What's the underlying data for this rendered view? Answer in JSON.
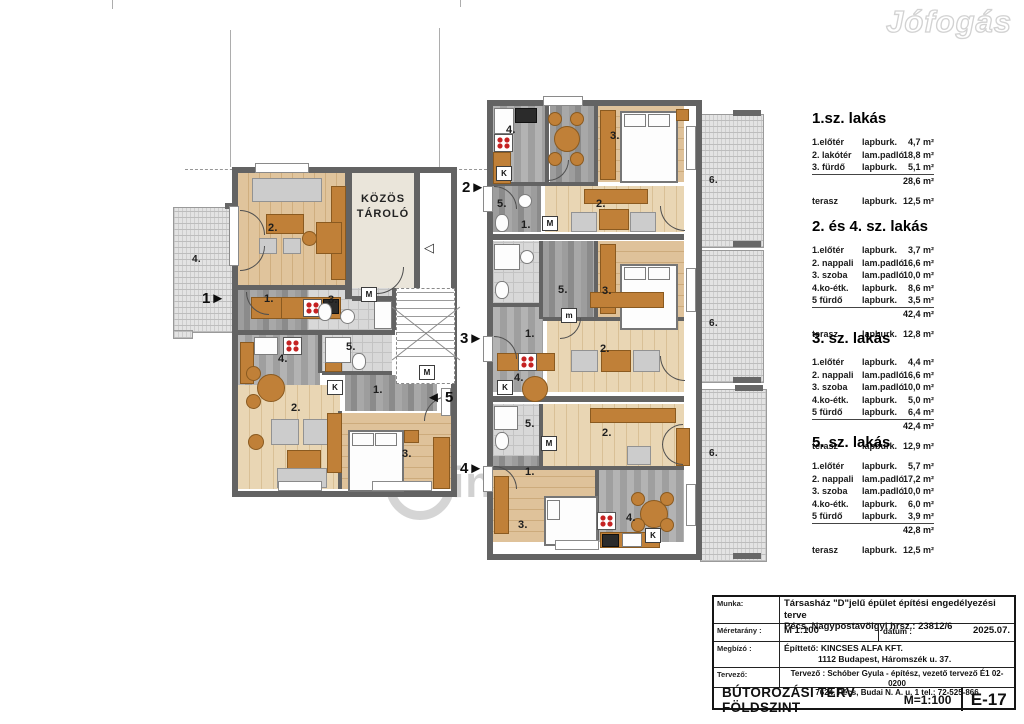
{
  "watermarks": {
    "top_right": "Jófogás",
    "center": "ingatlanpont"
  },
  "plan": {
    "kozos_line1": "KÖZÖS",
    "kozos_line2": "TÁROLÓ",
    "door_mark": "◁",
    "entrances": [
      "1►",
      "2►",
      "3►",
      "4►",
      "◄ 5"
    ],
    "terraces": [
      "4.",
      "6.",
      "6.",
      "6."
    ],
    "left_rooms": [
      "2.",
      "1.",
      "3.",
      "4.",
      "5.",
      "1.",
      "2.",
      "3."
    ],
    "u1_rooms": [
      "4.",
      "3.",
      "5.",
      "2.",
      "1."
    ],
    "u2_rooms": [
      "5.",
      "3.",
      "1.",
      "2.",
      "4."
    ],
    "u3_rooms": [
      "5.",
      "2.",
      "1.",
      "3.",
      "4."
    ],
    "appliances": [
      "M",
      "K",
      "M",
      "K",
      "M",
      "m",
      "K",
      "M",
      "K"
    ]
  },
  "legend": [
    {
      "title": "1.sz. lakás",
      "rows": [
        {
          "n": "1.előtér",
          "f": "lapburk.",
          "a": "4,7 m²"
        },
        {
          "n": "2. lakótér",
          "f": "lam.padló",
          "a": "18,8 m²"
        },
        {
          "n": "3. fürdő",
          "f": "lapburk.",
          "a": "5,1 m²"
        }
      ],
      "total": "28,6 m²",
      "tn": "terasz",
      "tf": "lapburk.",
      "ta": "12,5 m²"
    },
    {
      "title": "2. és 4. sz. lakás",
      "rows": [
        {
          "n": "1.előtér",
          "f": "lapburk.",
          "a": "3,7 m²"
        },
        {
          "n": "2. nappali",
          "f": "lam.padló",
          "a": "16,6 m²"
        },
        {
          "n": "3. szoba",
          "f": "lam.padló",
          "a": "10,0 m²"
        },
        {
          "n": "4.ko-étk.",
          "f": "lapburk.",
          "a": "8,6 m²"
        },
        {
          "n": "5 fürdő",
          "f": "lapburk.",
          "a": "3,5 m²"
        }
      ],
      "total": "42,4 m²",
      "tn": "terasz",
      "tf": "lapburk.",
      "ta": "12,8 m²"
    },
    {
      "title": "3. sz. lakás",
      "rows": [
        {
          "n": "1.előtér",
          "f": "lapburk.",
          "a": "4,4 m²"
        },
        {
          "n": "2. nappali",
          "f": "lam.padló",
          "a": "16,6 m²"
        },
        {
          "n": "3. szoba",
          "f": "lam.padló",
          "a": "10,0 m²"
        },
        {
          "n": "4.ko-étk.",
          "f": "lapburk.",
          "a": "5,0 m²"
        },
        {
          "n": "5 fürdő",
          "f": "lapburk.",
          "a": "6,4 m²"
        }
      ],
      "total": "42,4 m²",
      "tn": "terasz",
      "tf": "lapburk.",
      "ta": "12,9 m²"
    },
    {
      "title": "5. sz. lakás",
      "rows": [
        {
          "n": "1.előtér",
          "f": "lapburk.",
          "a": "5,7 m²"
        },
        {
          "n": "2. nappali",
          "f": "lam.padló",
          "a": "17,2 m²"
        },
        {
          "n": "3. szoba",
          "f": "lam.padló",
          "a": "10,0 m²"
        },
        {
          "n": "4.ko-étk.",
          "f": "lapburk.",
          "a": "6,0 m²"
        },
        {
          "n": "5 fürdő",
          "f": "lapburk.",
          "a": "3,9 m²"
        }
      ],
      "total": "42,8 m²",
      "tn": "terasz",
      "tf": "lapburk.",
      "ta": "12,5 m²"
    }
  ],
  "titleblock": {
    "munka_label": "Munka:",
    "munka_line1": "Társasház \"D\"jelű épület építési engedélyezési terve",
    "munka_line2": "Pécs, Nagypostavölgyi hrsz.: 23812/6",
    "meretarany_label": "Méretarány :",
    "meretarany": "M 1:100",
    "datum_label": "dátum :",
    "datum": "2025.07.",
    "megbizo_label": "Megbízó :",
    "epitteto_line1": "Építtető:  KINCSES ALFA KFT.",
    "epitteto_line2": "1112 Budapest, Háromszék u. 37.",
    "tervezo_label": "Tervező:",
    "tervezo_line1": "Tervező : Schóber Gyula - építész, vezető tervező É1 02-0200",
    "tervezo_line2": "7624, Pécs, Budai N. A. u. 1   tel.: 72-525-866",
    "drawing_title": "BÚTOROZÁSI TERV  FÖLDSZINT",
    "scale": "M=1:100",
    "sheet": "E-17"
  }
}
